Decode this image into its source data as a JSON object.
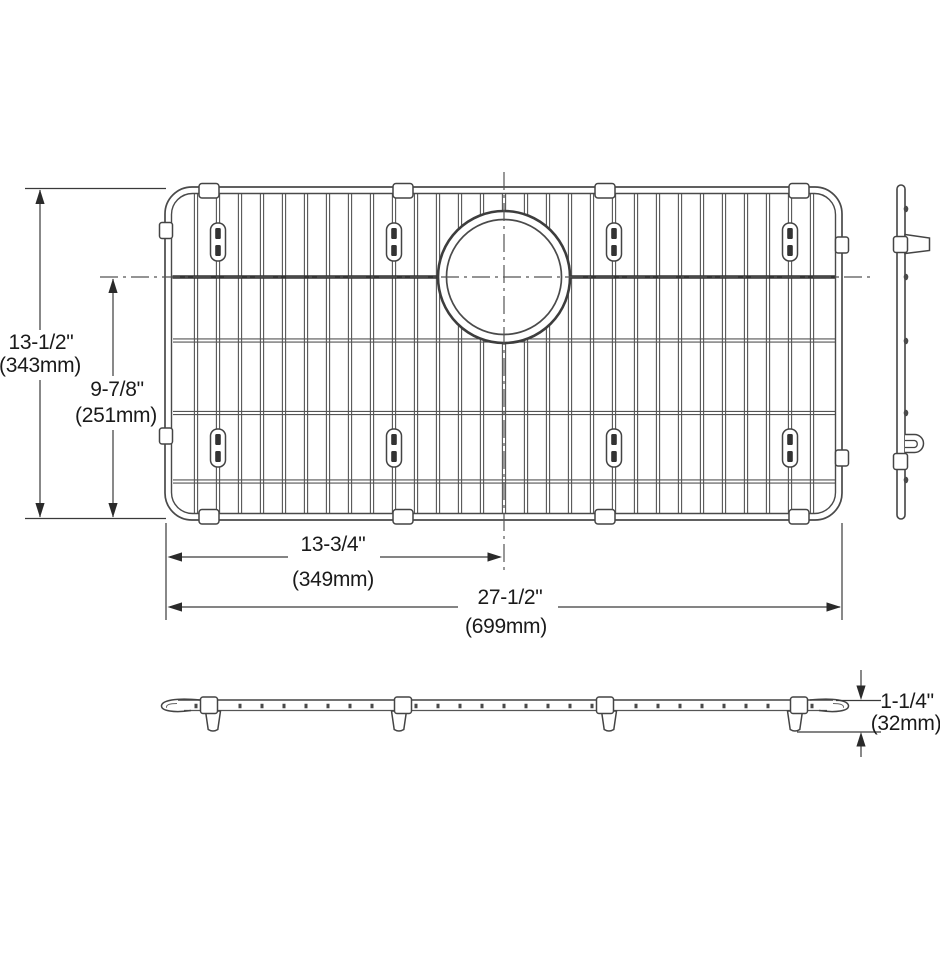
{
  "drawing": {
    "dimensions": {
      "overall_height": {
        "inches": "13-1/2\"",
        "mm": "(343mm)"
      },
      "partial_height": {
        "inches": "9-7/8\"",
        "mm": "(251mm)"
      },
      "center_offset": {
        "inches": "13-3/4\"",
        "mm": "(349mm)"
      },
      "overall_width": {
        "inches": "27-1/2\"",
        "mm": "(699mm)"
      },
      "thickness": {
        "inches": "1-1/4\"",
        "mm": "(32mm)"
      }
    },
    "colors": {
      "background": "#ffffff",
      "frame_line": "#4a4a4a",
      "wire_line": "#555555",
      "dark_wire": "#333333",
      "text": "#1a1a1a",
      "arrow": "#2a2a2a"
    }
  }
}
